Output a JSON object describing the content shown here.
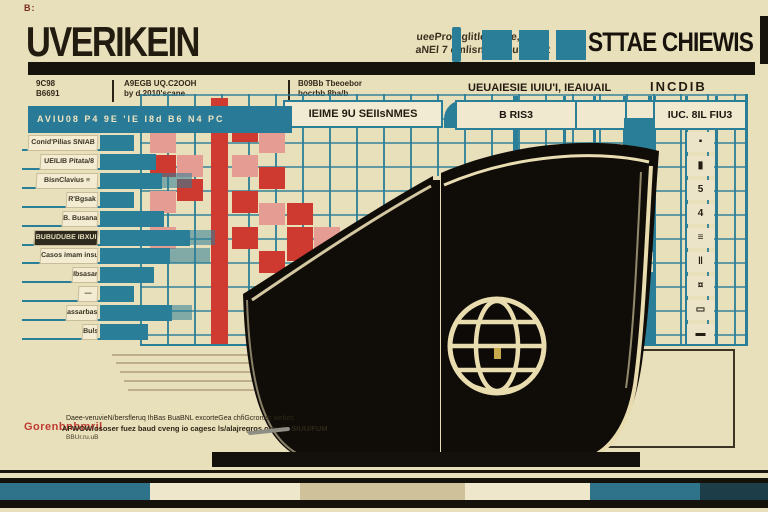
{
  "titles": {
    "corner_mark": "B:",
    "left_big": "UVERIKEIN",
    "left_note_1": "ueePromglitlor, ame, 6RP",
    "left_note_2": "aNEl 7 emlisnN, P.Lual. 3Bt",
    "right_big": "STTAE CHIEWIS"
  },
  "header": {
    "col1_line1": "9C98",
    "col1_line2": "B6691",
    "col2_line1": "A9EGB UQ.C2OOH",
    "col2_line2": "by d.2010'scane",
    "col3_line1": "B09Bb Tbeoebor",
    "col3_line2": "bocrbb 8ba/b",
    "center_cell": "IEIME 9U SEIIsNMES",
    "right_label": "UEUAIESIE IUIU'I, IEAIUAIL",
    "right_label_2": "INCDIB",
    "cell_left": "B RIS3",
    "cell_right": "IUC. 8IL FIU3",
    "teal_bar_text": "AVIU08 P4    9E    'IE I8d B6 N4 PC"
  },
  "left_chart": {
    "rows": [
      {
        "label": "Conid'Pilias SNIAB",
        "indent": 6,
        "bar": 34,
        "ext": 0,
        "dark": false
      },
      {
        "label": "UEILIB Pitata/8",
        "indent": 18,
        "bar": 56,
        "ext": 0,
        "dark": false
      },
      {
        "label": "BisnClavius ≡",
        "indent": 14,
        "bar": 62,
        "ext": 30,
        "dark": false
      },
      {
        "label": "R'Bgsak",
        "indent": 44,
        "bar": 34,
        "ext": 0,
        "dark": false
      },
      {
        "label": "B. Busana IL",
        "indent": 40,
        "bar": 64,
        "ext": 0,
        "dark": false
      },
      {
        "label": "BUBUDUBE IBXUI",
        "indent": 12,
        "bar": 90,
        "ext": 25,
        "dark": true
      },
      {
        "label": "Casos imam insubur",
        "indent": 18,
        "bar": 70,
        "ext": 40,
        "dark": false
      },
      {
        "label": "Ibsasarbaca",
        "indent": 50,
        "bar": 54,
        "ext": 0,
        "dark": false
      },
      {
        "label": "—",
        "indent": 56,
        "bar": 34,
        "ext": 0,
        "dark": false
      },
      {
        "label": "assarbassbas",
        "indent": 44,
        "bar": 72,
        "ext": 20,
        "dark": false
      },
      {
        "label": "Bulsuburd",
        "indent": 60,
        "bar": 48,
        "ext": 0,
        "dark": false
      }
    ]
  },
  "grid": {
    "red_cells": [
      [
        150,
        107,
        26,
        22,
        0
      ],
      [
        177,
        107,
        26,
        22,
        1
      ],
      [
        232,
        118,
        26,
        24,
        0
      ],
      [
        150,
        131,
        26,
        22,
        1
      ],
      [
        259,
        131,
        26,
        22,
        1
      ],
      [
        150,
        155,
        26,
        22,
        0
      ],
      [
        177,
        155,
        26,
        22,
        1
      ],
      [
        232,
        155,
        26,
        22,
        1
      ],
      [
        259,
        167,
        26,
        22,
        0
      ],
      [
        150,
        191,
        26,
        22,
        1
      ],
      [
        177,
        179,
        26,
        22,
        0
      ],
      [
        232,
        191,
        26,
        22,
        0
      ],
      [
        259,
        203,
        26,
        22,
        1
      ],
      [
        287,
        203,
        26,
        22,
        0
      ],
      [
        150,
        227,
        26,
        22,
        1
      ],
      [
        232,
        227,
        26,
        22,
        0
      ],
      [
        287,
        227,
        26,
        34,
        0
      ],
      [
        314,
        227,
        26,
        22,
        1
      ],
      [
        259,
        251,
        26,
        22,
        0
      ],
      [
        314,
        251,
        26,
        22,
        0
      ],
      [
        287,
        275,
        26,
        22,
        1
      ],
      [
        314,
        275,
        26,
        22,
        0
      ],
      [
        341,
        263,
        20,
        34,
        1
      ]
    ],
    "heavy_verticals": [
      563,
      593,
      623,
      653,
      685,
      715
    ],
    "emphasis_verticals": [
      [
        513,
        96,
        5,
        104
      ],
      [
        648,
        96,
        4,
        110
      ]
    ],
    "drips": [
      [
        507,
        185,
        12,
        14
      ],
      [
        644,
        200,
        12,
        16
      ]
    ]
  },
  "right_table": {
    "bar_segments": [
      [
        118,
        34
      ],
      [
        170,
        30
      ],
      [
        220,
        32
      ],
      [
        272,
        72
      ]
    ],
    "glyphs": [
      "▪",
      "▮",
      "5",
      "4",
      "≡",
      "‖",
      "¤",
      "▭",
      "▬"
    ]
  },
  "book": {
    "emblem": "globe-icon"
  },
  "footer": {
    "red_label": "Gorenbnbmril",
    "line1": "Daee-veruvieN/bersfleruq IhBas BuaBNL excorteGea chfiGcrorusr webes",
    "line2": "AFWOW/ososer fuez baud cveng io cagesc ls/alajregros.orevris    SIUU/FUM",
    "line3": "BBUr.ru.uB"
  },
  "colors": {
    "background": "#e8dfbb",
    "teal": "#2b7e98",
    "red": "#ce3a30",
    "red_light": "#e59d93",
    "black": "#15120c",
    "tab_cream": "#f3ecd2",
    "trim_gold": "#e9dcae",
    "band_tan": "#cfc29b"
  },
  "bottom_band_segments": [
    {
      "w": 150,
      "c": "#2e7389"
    },
    {
      "w": 150,
      "c": "#efe7cc"
    },
    {
      "w": 165,
      "c": "#cfc29b"
    },
    {
      "w": 125,
      "c": "#efe7cc"
    },
    {
      "w": 110,
      "c": "#2e7389"
    },
    {
      "w": 68,
      "c": "#1d3d49"
    }
  ]
}
